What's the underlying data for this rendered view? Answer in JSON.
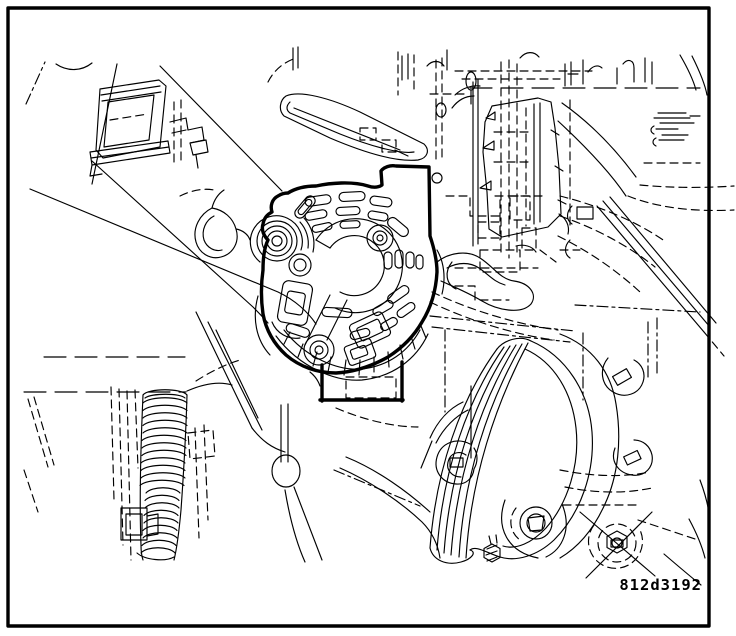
{
  "figure": {
    "code": "812d3192"
  },
  "colors": {
    "line": "#000000",
    "background": "#ffffff"
  }
}
